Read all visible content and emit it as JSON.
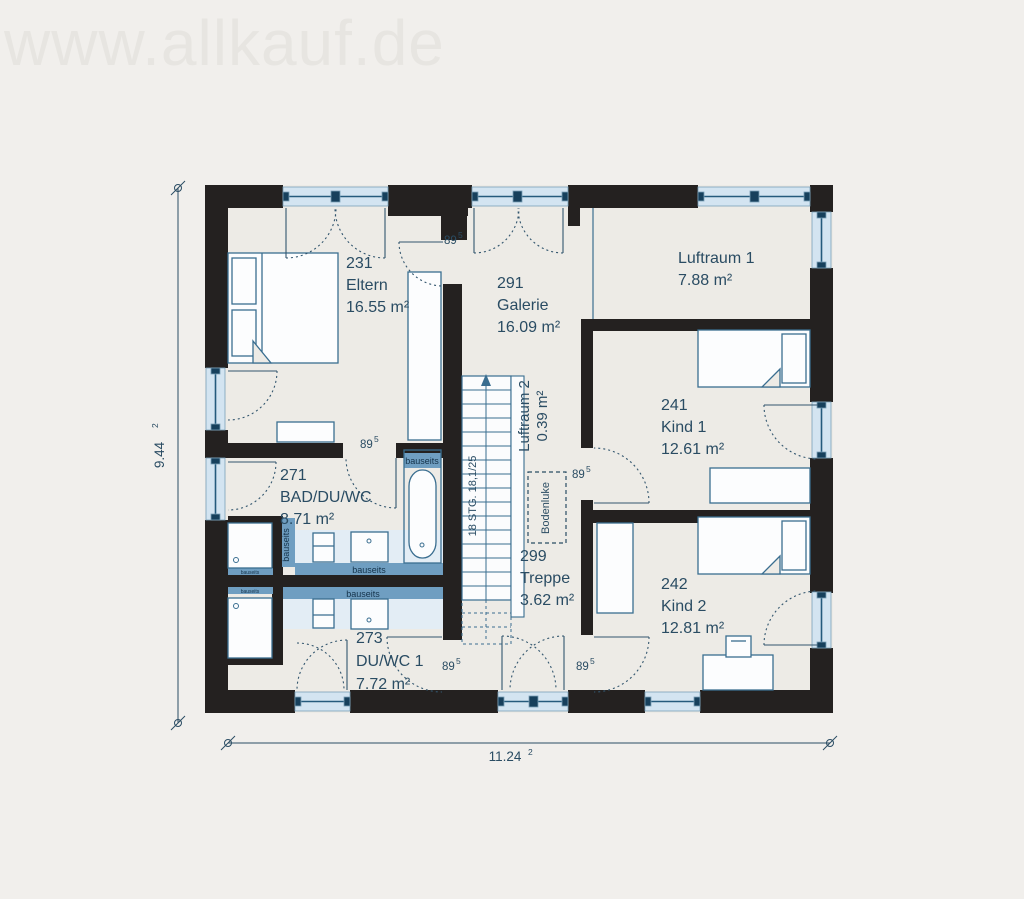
{
  "watermark": "www.allkauf.de",
  "rooms": {
    "eltern": {
      "id": "231",
      "name": "Eltern",
      "area": "16.55 m²"
    },
    "galerie": {
      "id": "291",
      "name": "Galerie",
      "area": "16.09 m²"
    },
    "luftraum1": {
      "name": "Luftraum 1",
      "area": "7.88 m²"
    },
    "kind1": {
      "id": "241",
      "name": "Kind 1",
      "area": "12.61 m²"
    },
    "kind2": {
      "id": "242",
      "name": "Kind 2",
      "area": "12.81 m²"
    },
    "bad": {
      "id": "271",
      "name": "BAD/DU/WC",
      "area": "8.71 m²"
    },
    "duwc": {
      "id": "273",
      "name": "DU/WC 1",
      "area": "7.72 m²"
    },
    "treppe": {
      "id": "299",
      "name": "Treppe",
      "area": "3.62 m²"
    },
    "luftraum2": {
      "name": "Luftraum 2",
      "area": "0.39 m²"
    }
  },
  "annotations": {
    "door_width": "89",
    "door_width_sup": "5",
    "bauseits": "bauseits",
    "stairs_spec": "18 STG. 18,1/25",
    "hatch": "Bodenluke"
  },
  "dimensions": {
    "width": "11.24",
    "width_sup": "2",
    "height": "9.44",
    "height_sup": "2"
  },
  "colors": {
    "wall": "#242120",
    "window_glass": "#d3e4f1",
    "window_frame": "#255a7c",
    "bauseits_blue": "#6f9ec1",
    "label_text": "#2a4c63",
    "thin_line": "#3a6e90",
    "background": "#f1efec"
  }
}
